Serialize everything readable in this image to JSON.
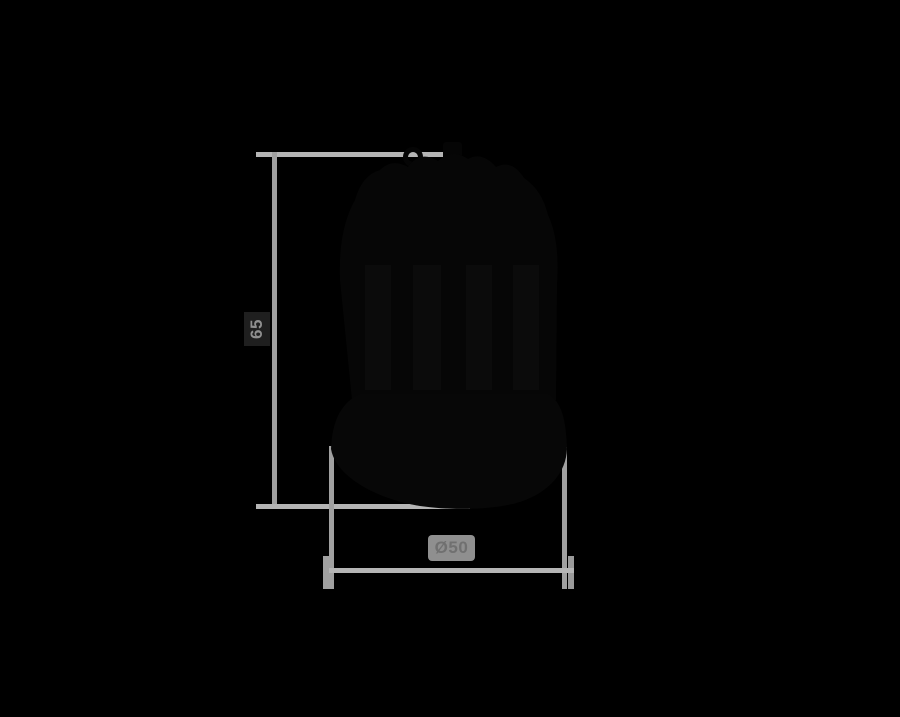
{
  "page": {
    "background": "#000000",
    "description": "Technical dimension drawing of a dark pendant-lamp-shaped product on a black background"
  },
  "diagram": {
    "type": "product-dimension-diagram",
    "product": {
      "name": "lamp-silhouette",
      "fill": "#060606"
    },
    "dimensions": {
      "height": {
        "label": "65"
      },
      "diameter": {
        "label": "Ø50"
      }
    },
    "colors": {
      "extension_line": "#b5b5b5",
      "dimension_line": "#a0a0a0",
      "height_label_text": "#8f8f8f",
      "height_label_bg": "#1f1f1f",
      "diameter_label_text": "#707070",
      "diameter_label_bg": "#8f8f8f",
      "object_fill": "#060606"
    }
  }
}
